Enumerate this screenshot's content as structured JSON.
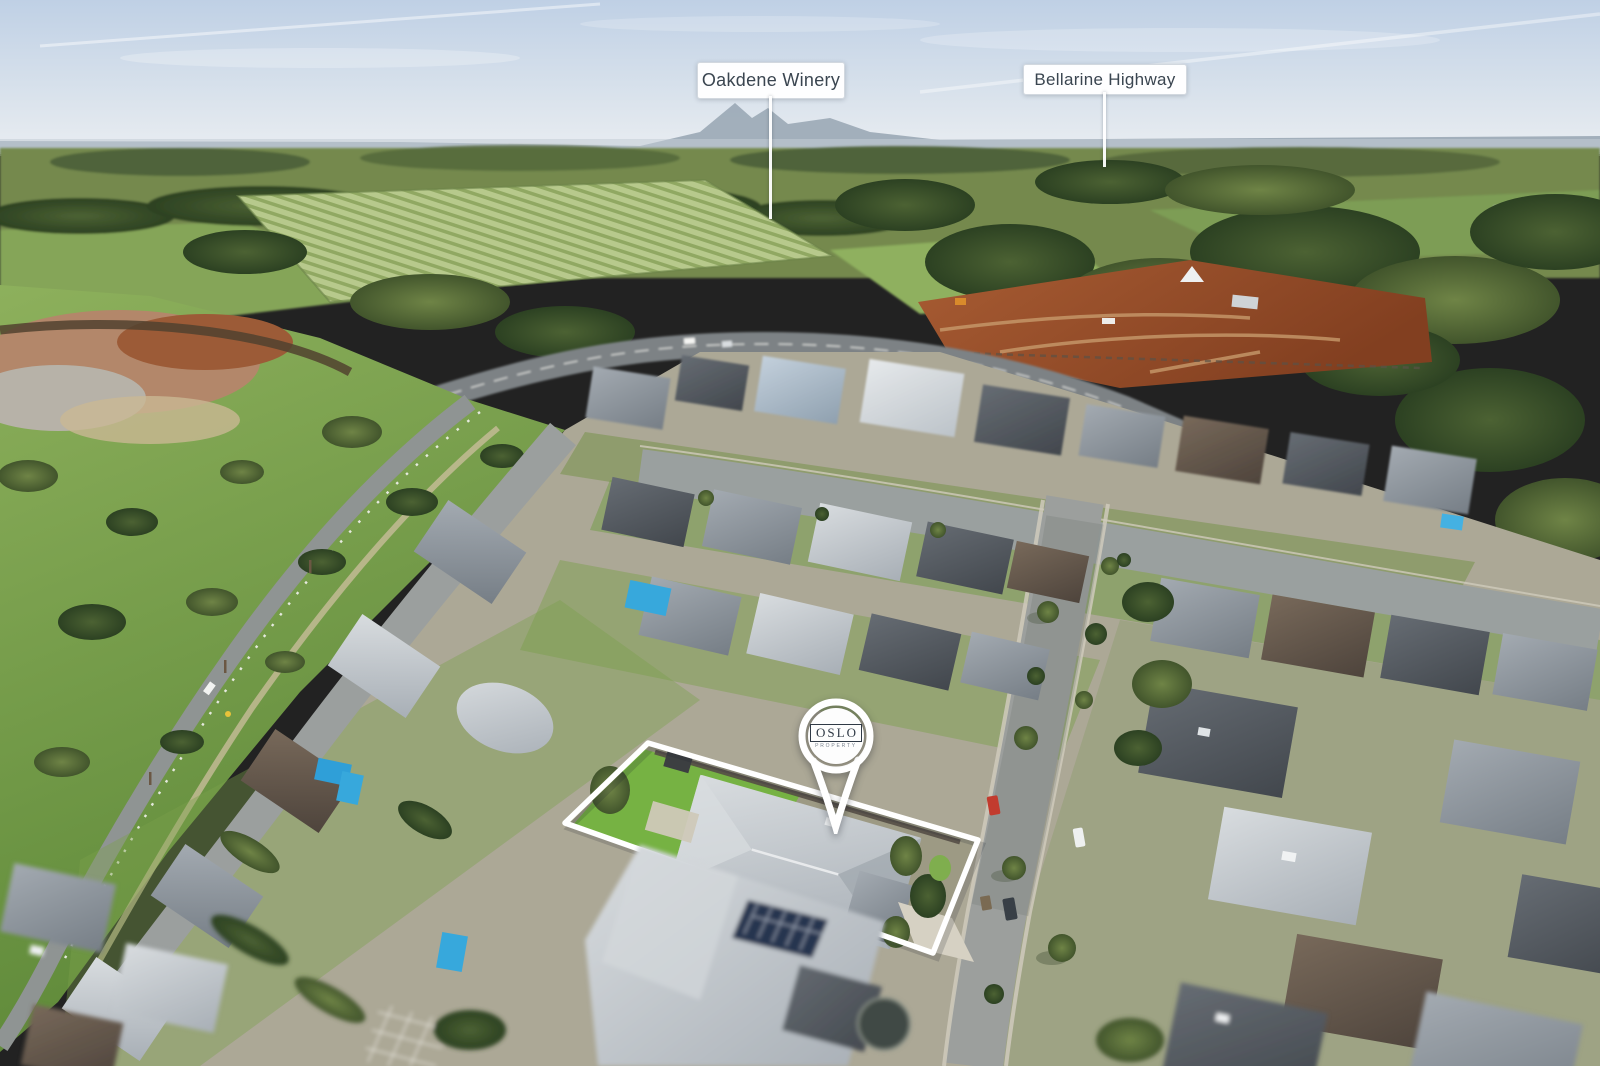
{
  "annotations": {
    "labels": [
      {
        "text": "Oakdene Winery"
      },
      {
        "text": "Bellarine Highway"
      }
    ],
    "pin": {
      "brand": "OSLO",
      "sub": "PROPERTY"
    }
  },
  "colors": {
    "sky_top": "#c3d3e6",
    "sky_horizon": "#e7ecf1",
    "ridge_haze": "#98a6b3",
    "far_field": "#74894d",
    "vineyard": "#b7c98c",
    "tree_dark": "#31472a",
    "park_green": "#7aa44c",
    "marsh_brown": "#ad6a42",
    "construction_dirt": "#9c5530",
    "road_asphalt": "#9b9f9d",
    "roof_light": "#c9ced3",
    "roof_mid": "#8d949b",
    "roof_dark": "#51565c",
    "roof_brown": "#6b6055",
    "pool_blue": "#37a8dc",
    "solar_panel": "#26344f",
    "marker_white": "#ffffff",
    "label_text": "#3a4550",
    "logo_navy": "#2f3945"
  }
}
